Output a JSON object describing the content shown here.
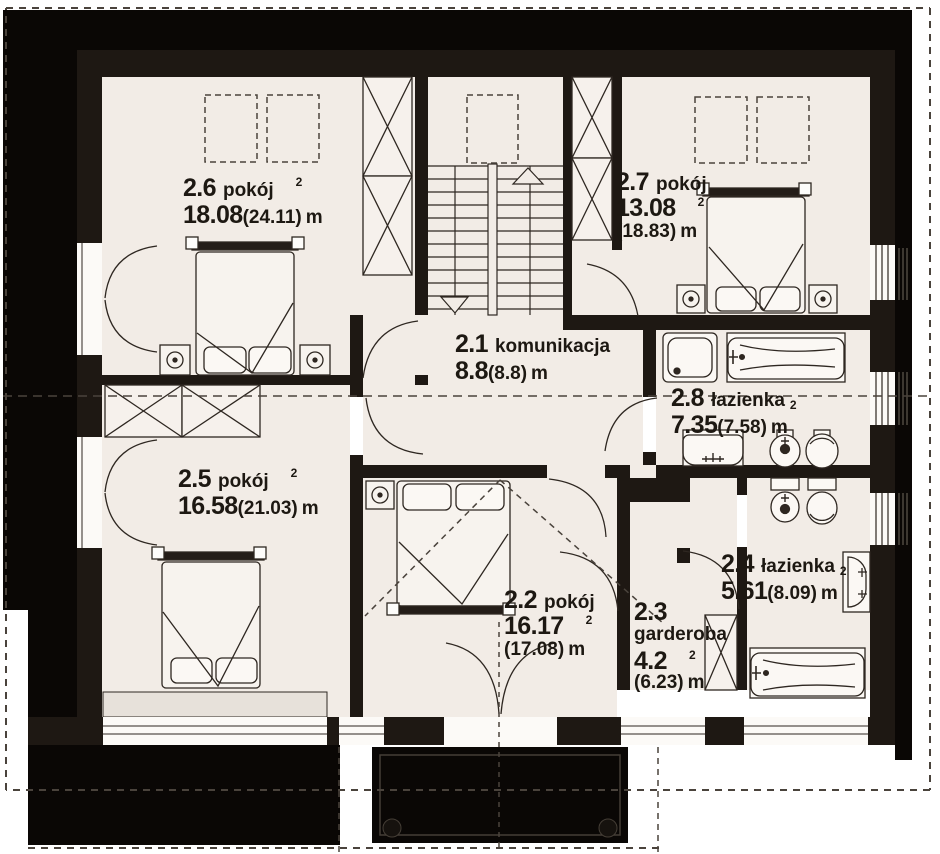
{
  "colors": {
    "background": "#ffffff",
    "floor": "#f2ece6",
    "wall": "#1e1813",
    "outer_mass": "#0a0705",
    "furniture_line": "#2e2721",
    "text": "#1d1812"
  },
  "unit_suffix": "m",
  "sup": "2",
  "rooms": [
    {
      "id": "2.6",
      "name": "pokój",
      "area": "18.08",
      "area_gross": "(24.11)",
      "unit": "m",
      "sup": "2"
    },
    {
      "id": "2.7",
      "name": "pokój",
      "area": "13.08",
      "area_gross": "(18.83)",
      "unit": "m",
      "sup": "2"
    },
    {
      "id": "2.1",
      "name": "komunikacja",
      "area": "8.8",
      "area_gross": "(8.8)",
      "unit": "m",
      "sup": ""
    },
    {
      "id": "2.8",
      "name": "łazienka",
      "area": "7.35",
      "area_gross": "(7.58)",
      "unit": "m",
      "sup": "2"
    },
    {
      "id": "2.5",
      "name": "pokój",
      "area": "16.58",
      "area_gross": "(21.03)",
      "unit": "m",
      "sup": "2"
    },
    {
      "id": "2.2",
      "name": "pokój",
      "area": "16.17",
      "area_gross": "(17.08)",
      "unit": "m",
      "sup": "2"
    },
    {
      "id": "2.3",
      "name": "garderoba",
      "area": "4.2",
      "area_gross": "(6.23)",
      "unit": "m",
      "sup": "2"
    },
    {
      "id": "2.4",
      "name": "łazienka",
      "area": "5.61",
      "area_gross": "(8.09)",
      "unit": "m",
      "sup": "2"
    }
  ],
  "fixtures": [
    "double-bed",
    "nightstand-lamp",
    "wardrobe",
    "built-in-closet",
    "stairs",
    "chimney-shaft",
    "bathtub",
    "shower",
    "washbasin",
    "toilet",
    "bidet",
    "balcony",
    "casement-window",
    "door"
  ]
}
